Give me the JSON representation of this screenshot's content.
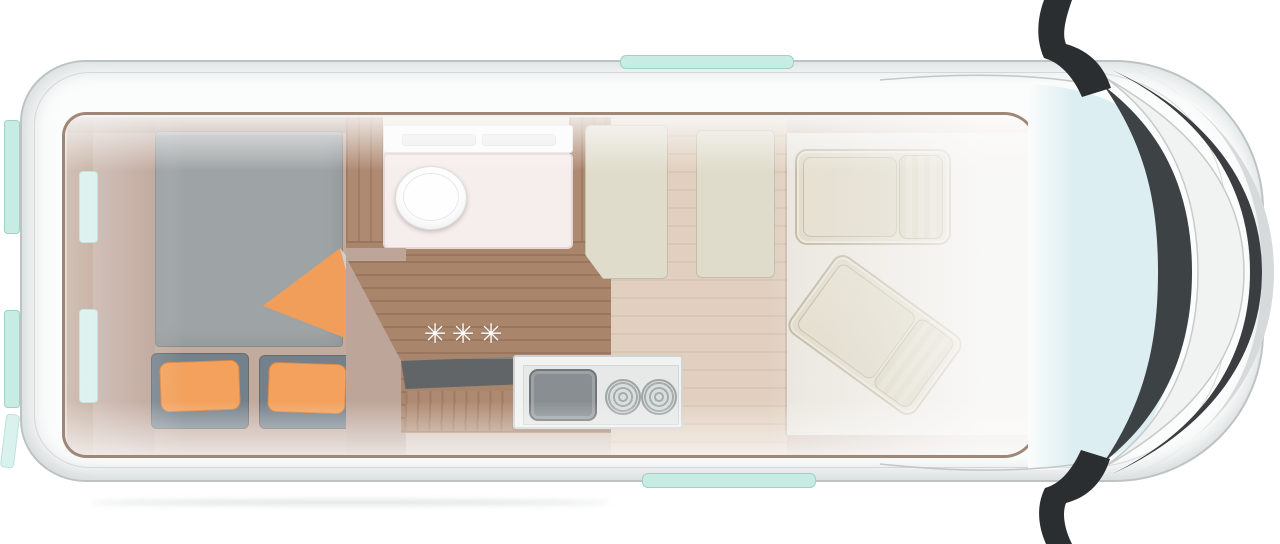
{
  "diagram": {
    "type": "campervan-floorplan-top-view",
    "regions": [
      "rear-transverse-bed",
      "wardrobe",
      "bathroom-with-toilet",
      "kitchen-block-with-sink-and-burners",
      "corridor",
      "bench-panels",
      "swivel-cab-seats",
      "cab-windshield"
    ],
    "window_count": {
      "rear_tabs": 2,
      "interior_rear_windows": 2,
      "side_door_strips": 2
    }
  },
  "decor": {
    "star_glyph": "✳",
    "star_count": 3
  },
  "palette": {
    "body_white": "#fbfcfc",
    "outline_gray": "#bdc2c2",
    "accent_teal": "#c6ece4",
    "accent_orange": "#ef8d3e",
    "mattress_gray": "#8e9496",
    "pillow_slate": "#5d6b76",
    "wood_walnut": "#9b7053",
    "wood_light_oak": "#dcc8b5",
    "bed_floor_tan": "#b59a89",
    "seat_beige": "#d9d2bc",
    "shower_white": "#f5ebe9",
    "stainless": "#eff1f0",
    "windshield_glass": "#dceef1",
    "dark_trim": "#3c4144",
    "mirror_black": "#2b2e30"
  }
}
